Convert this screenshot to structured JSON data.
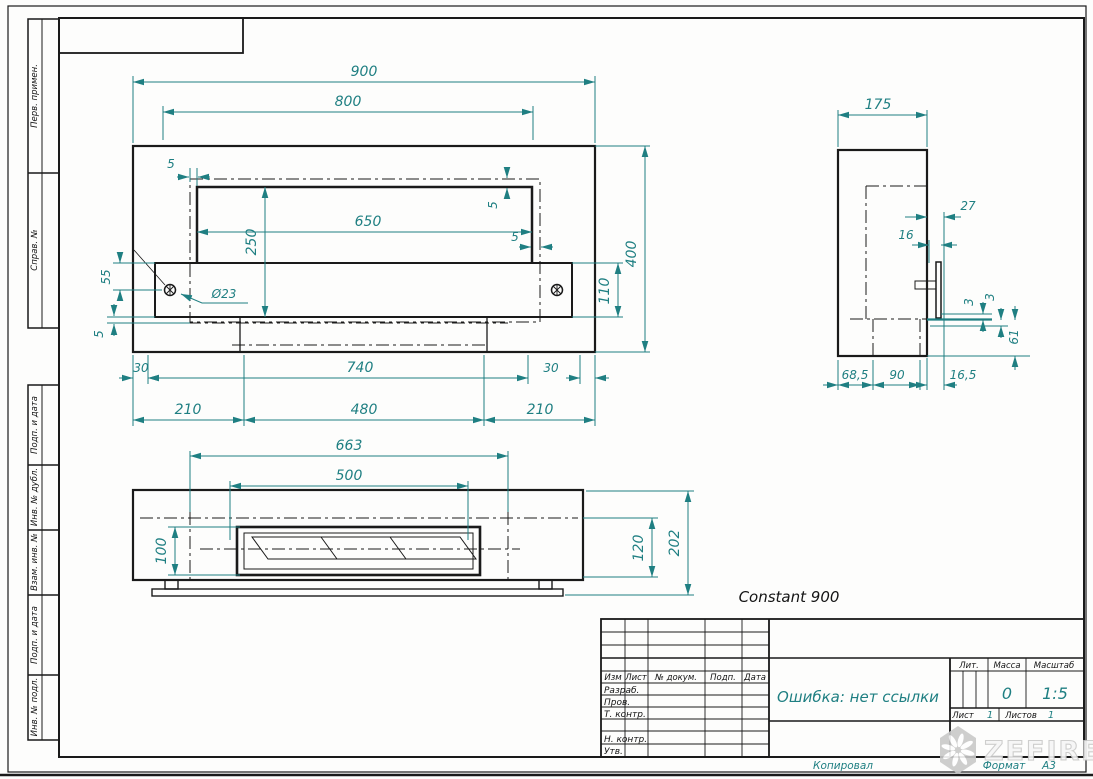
{
  "sheet": {
    "copied": "Копировал",
    "format_label": "Формат",
    "format_value": "А3"
  },
  "margin": {
    "upper": [
      {
        "label": "Перв. примен."
      },
      {
        "label": "Справ. №"
      }
    ],
    "lower": [
      {
        "label": "Подп. и дата"
      },
      {
        "label": "Инв. № дубл."
      },
      {
        "label": "Взам. инв. №"
      },
      {
        "label": "Подп. и дата"
      },
      {
        "label": "Инв. № подл."
      }
    ]
  },
  "drawing": {
    "title": "Constant 900",
    "front": {
      "w900": "900",
      "w800": "800",
      "w650": "650",
      "h250": "250",
      "h400": "400",
      "h110": "110",
      "h55": "55",
      "dia": "Ø23",
      "g5a": "5",
      "g5b": "5",
      "g5c": "5",
      "g5d": "5",
      "b30l": "30",
      "b740": "740",
      "b30r": "30",
      "r210l": "210",
      "r480": "480",
      "r210r": "210"
    },
    "plan": {
      "w663": "663",
      "w500": "500",
      "h100": "100",
      "h120": "120",
      "h202": "202"
    },
    "side": {
      "w175": "175",
      "o27": "27",
      "o16": "16",
      "g3a": "3",
      "g3b": "3",
      "h61": "61",
      "b68": "68,5",
      "b90": "90",
      "b16": "16,5"
    }
  },
  "title_block": {
    "cols": {
      "izm": "Изм",
      "list": "Лист",
      "doc": "№ докум.",
      "podp": "Подп.",
      "data": "Дата"
    },
    "rows": {
      "razrab": "Разраб.",
      "prov": "Пров.",
      "tkontr": "Т. контр.",
      "nkontr": "Н. контр.",
      "utv": "Утв."
    },
    "name": "Ошибка: нет ссылки",
    "lit_label": "Лит.",
    "mass_label": "Масса",
    "scale_label": "Масштаб",
    "mass": "0",
    "scale": "1:5",
    "sheet_label": "Лист",
    "sheet_value": "1",
    "sheets_label": "Листов",
    "sheets_value": "1"
  },
  "logo": {
    "text": "ZEFIRE"
  },
  "colors": {
    "dimension": "#1f7f82",
    "line": "#1a1a1a",
    "watermark": "#c9c9c9"
  }
}
